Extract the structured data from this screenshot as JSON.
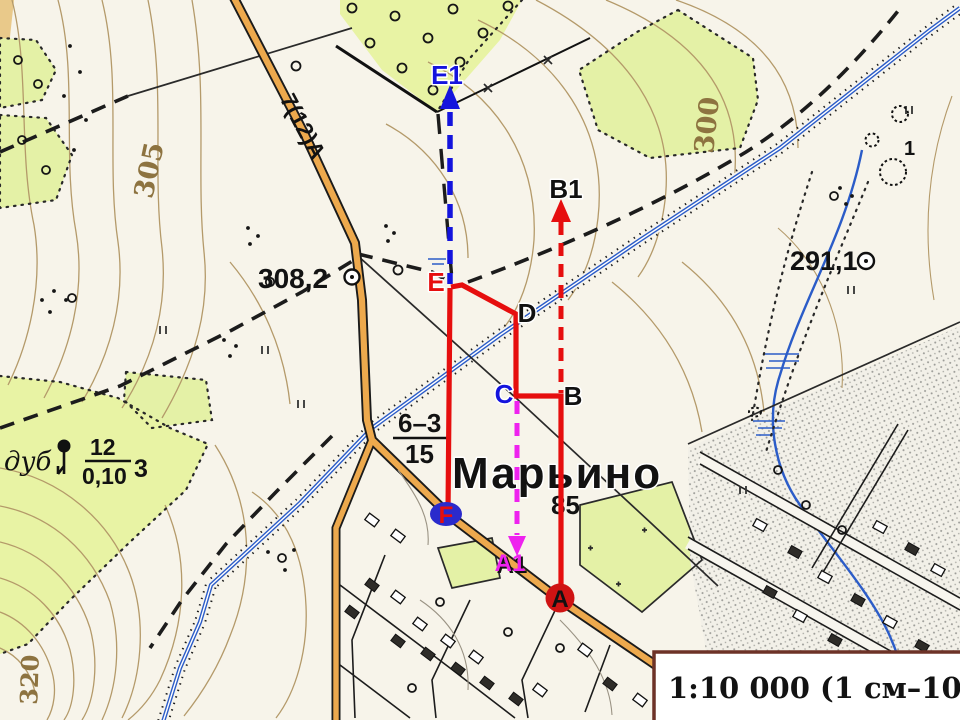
{
  "map": {
    "scale_bar_text": "1:10 000 (1 см–100 м)",
    "labels": {
      "village_name": "Марьино",
      "block_number": "85",
      "spot_height_main": "308,2",
      "spot_height_east": "291,1",
      "contour_west": "305",
      "contour_northeast": "300",
      "contour_southwest": "320",
      "road_characteristics": "7(12)А",
      "bridge_clearance_top": "6–3",
      "bridge_clearance_bottom": "15",
      "forest_species": "дуб",
      "forest_height_m": "12",
      "forest_trunk_diameter_m": "0,10",
      "forest_spacing_m": "3",
      "pit_depth_m": "1"
    },
    "colors": {
      "paper": "#f7f4ea",
      "vegetation": "#e4f1a6",
      "contour": "#b49a6a",
      "road_fill": "#eda94d",
      "water": "#2b5cc8"
    }
  },
  "route": {
    "points": {
      "A": "A",
      "B": "B",
      "C": "C",
      "D": "D",
      "E": "E",
      "F": "F",
      "A1": "A1",
      "B1": "B1",
      "E1": "E1"
    },
    "colors": {
      "main_line": "#e60e0e",
      "bearing_line_blue": "#1414dd",
      "bearing_line_red": "#e60e0e",
      "offset_line_magenta": "#ee22ee",
      "marker_a_fill": "#cf1313",
      "marker_f_fill": "#2a2acc"
    }
  }
}
